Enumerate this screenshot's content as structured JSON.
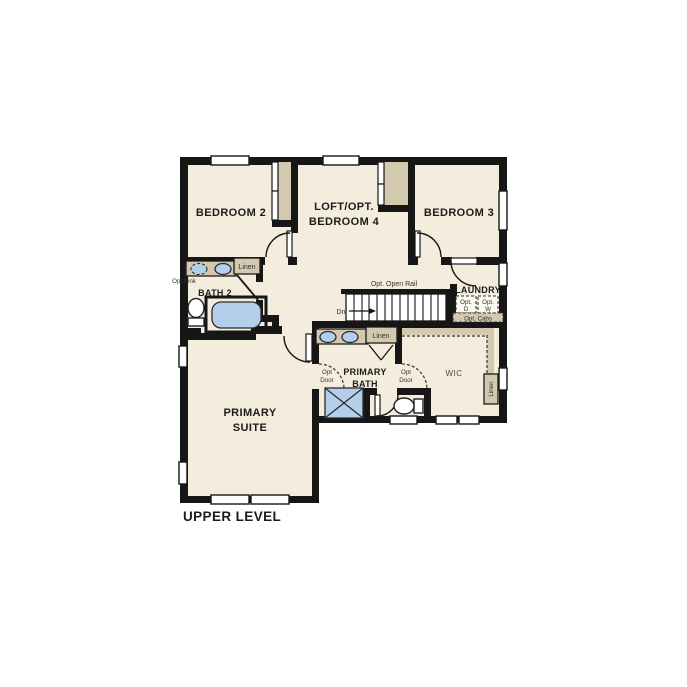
{
  "plan": {
    "title": "UPPER LEVEL",
    "colors": {
      "wall": "#161616",
      "floor": "#f4edde",
      "casework": "#d4c8af",
      "fixture": "#b3cfec",
      "ink": "#1c1c1c"
    },
    "rooms": {
      "bedroom2": {
        "label": "BEDROOM 2"
      },
      "loft": {
        "line1": "LOFT/OPT.",
        "line2": "BEDROOM 4"
      },
      "bedroom3": {
        "label": "BEDROOM 3"
      },
      "bath2": {
        "label": "BATH 2"
      },
      "laundry": {
        "label": "LAUNDRY"
      },
      "primary_bath": {
        "line1": "PRIMARY",
        "line2": "BATH"
      },
      "wic": {
        "label": "WIC"
      },
      "primary_suite": {
        "line1": "PRIMARY",
        "line2": "SUITE"
      }
    },
    "labels": {
      "opt_sink": "Opt.Sink",
      "bath2_linen": "Linen",
      "opt_open_rail": "Opt. Open Rail",
      "stairs_dn": "Dn",
      "opt_d_line1": "Opt.",
      "opt_d_line2": "D",
      "opt_w_line1": "Opt.",
      "opt_w_line2": "W",
      "opt_cabs": "Opt. Cabs",
      "primary_bath_linen": "Linen",
      "opt_door_line1": "Opt",
      "opt_door_line2": "Door",
      "wic_linen": "Linen"
    }
  }
}
